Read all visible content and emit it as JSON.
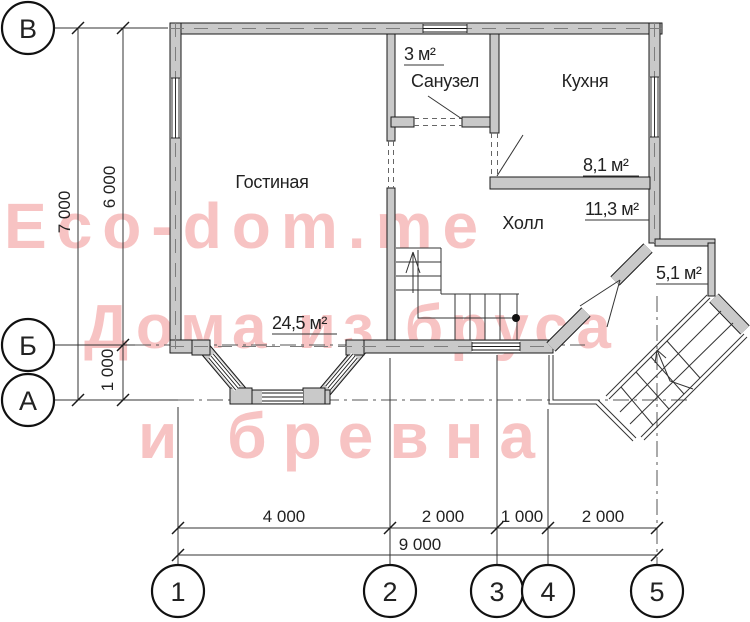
{
  "watermark": {
    "lines": [
      "Eco-dom.me",
      "Дома из бруса",
      "и бревна"
    ],
    "color": "#f7c3c3"
  },
  "axis_markers": {
    "rows": [
      {
        "id": "В"
      },
      {
        "id": "Б"
      },
      {
        "id": "А"
      }
    ],
    "cols": [
      {
        "id": "1"
      },
      {
        "id": "2"
      },
      {
        "id": "3"
      },
      {
        "id": "4"
      },
      {
        "id": "5"
      }
    ]
  },
  "dimensions": {
    "vertical": [
      {
        "label": "7 000"
      },
      {
        "label": "6 000"
      },
      {
        "label": "1 000"
      }
    ],
    "horizontal": [
      {
        "label": "4 000"
      },
      {
        "label": "2 000"
      },
      {
        "label": "1 000"
      },
      {
        "label": "2 000"
      },
      {
        "label": "9 000"
      }
    ]
  },
  "rooms": {
    "living": {
      "name": "Гостиная",
      "area": "24,5 м²"
    },
    "bath": {
      "name": "Санузел",
      "area": "3 м²"
    },
    "kitchen": {
      "name": "Кухня",
      "area": "8,1 м²"
    },
    "hall": {
      "name": "Холл",
      "area": "11,3 м²"
    },
    "porch": {
      "area": "5,1 м²"
    }
  },
  "colors": {
    "wall_fill": "#c9c9c9",
    "line": "#1a1a1a",
    "watermark": "#f7c3c3"
  }
}
